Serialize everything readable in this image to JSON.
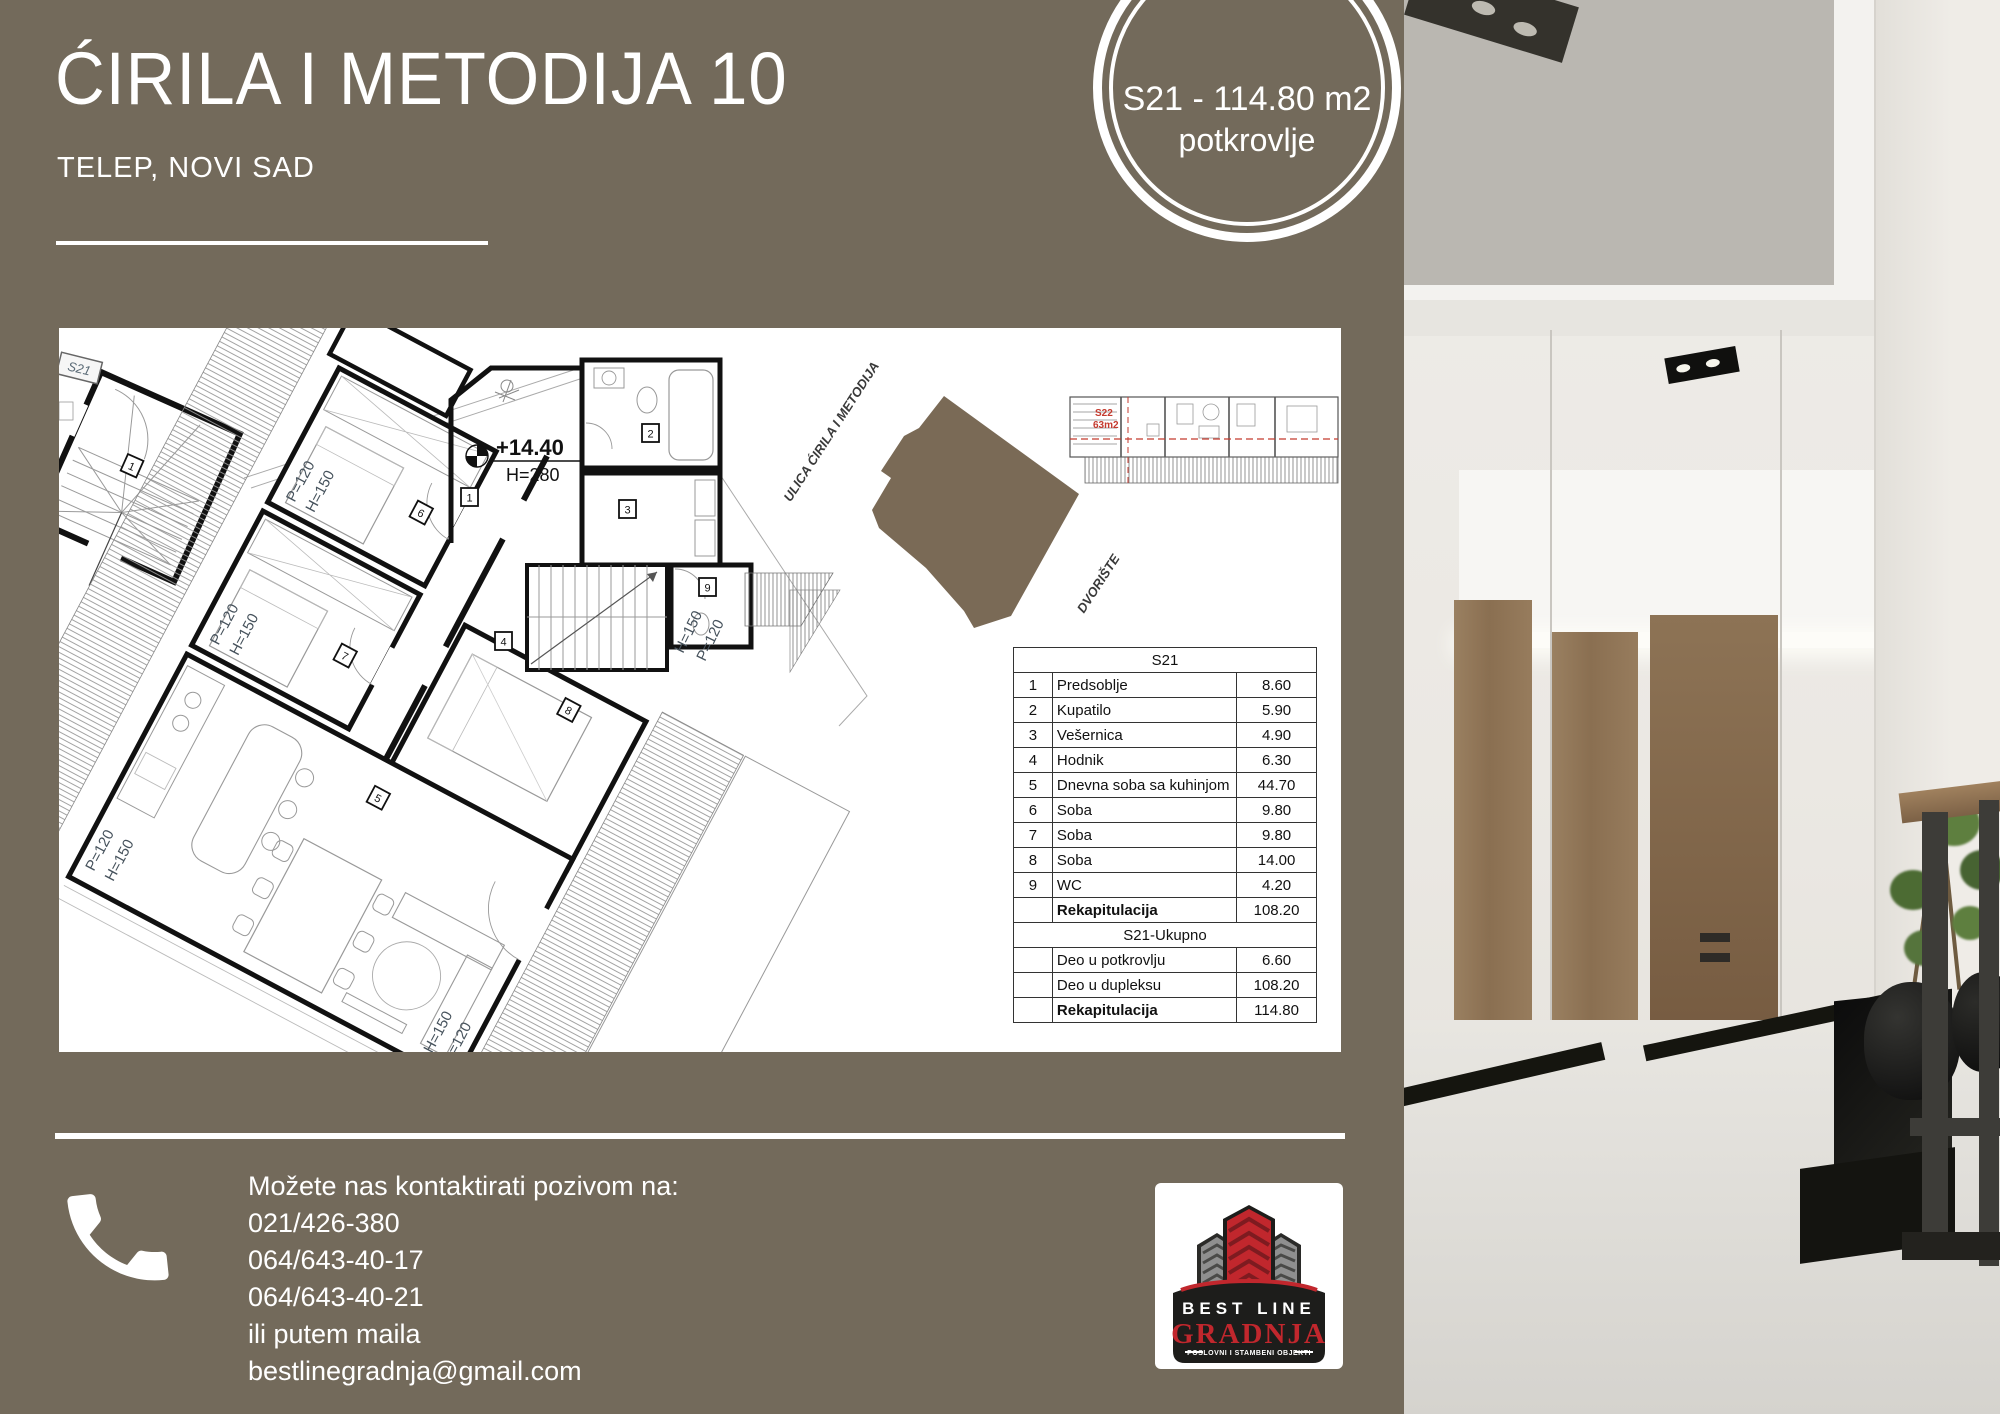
{
  "colors": {
    "background": "#736a5b",
    "panel": "#ffffff",
    "site_fill": "#7a6a56",
    "accent_red": "#c1272d",
    "red_mark": "#c43a2e",
    "plan_line": "#1a1a1a",
    "text_white": "#ffffff"
  },
  "header": {
    "title": "ĆIRILA I METODIJA 10",
    "subtitle": "TELEP, NOVI SAD"
  },
  "badge": {
    "line1": "S21 - 114.80 m2",
    "line2": "potkrovlje"
  },
  "plan": {
    "detail_tag": "S21",
    "elevation": "+14.40",
    "floor_height": "H=280",
    "dim_p": "P=120",
    "dim_h": "H=150",
    "strip_unit": "S22",
    "strip_area": "63m2",
    "street": "ULICA ĆIRILA I METODIJA",
    "yard": "DVORIŠTE",
    "rooms": [
      "1",
      "2",
      "3",
      "4",
      "5",
      "6",
      "7",
      "8",
      "9"
    ]
  },
  "table": {
    "title": "S21",
    "rows": [
      {
        "num": "1",
        "name": "Predsoblje",
        "value": "8.60"
      },
      {
        "num": "2",
        "name": "Kupatilo",
        "value": "5.90"
      },
      {
        "num": "3",
        "name": "Vešernica",
        "value": "4.90"
      },
      {
        "num": "4",
        "name": "Hodnik",
        "value": "6.30"
      },
      {
        "num": "5",
        "name": "Dnevna soba sa kuhinjom",
        "value": "44.70"
      },
      {
        "num": "6",
        "name": "Soba",
        "value": "9.80"
      },
      {
        "num": "7",
        "name": "Soba",
        "value": "9.80"
      },
      {
        "num": "8",
        "name": "Soba",
        "value": "14.00"
      },
      {
        "num": "9",
        "name": "WC",
        "value": "4.20"
      }
    ],
    "rekap": {
      "name": "Rekapitulacija",
      "value": "108.20"
    },
    "section2": "S21-Ukupno",
    "rows2": [
      {
        "name": "Deo u potkrovlju",
        "value": "6.60"
      },
      {
        "name": "Deo u dupleksu",
        "value": "108.20"
      }
    ],
    "rekap2": {
      "name": "Rekapitulacija",
      "value": "114.80"
    }
  },
  "contact": {
    "intro": "Možete nas kontaktirati pozivom na:",
    "phone1": "021/426-380",
    "phone2": "064/643-40-17",
    "phone3": "064/643-40-21",
    "mail_note": "ili putem maila",
    "email": "bestlinegradnja@gmail.com"
  },
  "logo": {
    "top": "BEST LINE",
    "main": "GRADNJA",
    "tagline": "POSLOVNI I STAMBENI OBJEKTI"
  }
}
